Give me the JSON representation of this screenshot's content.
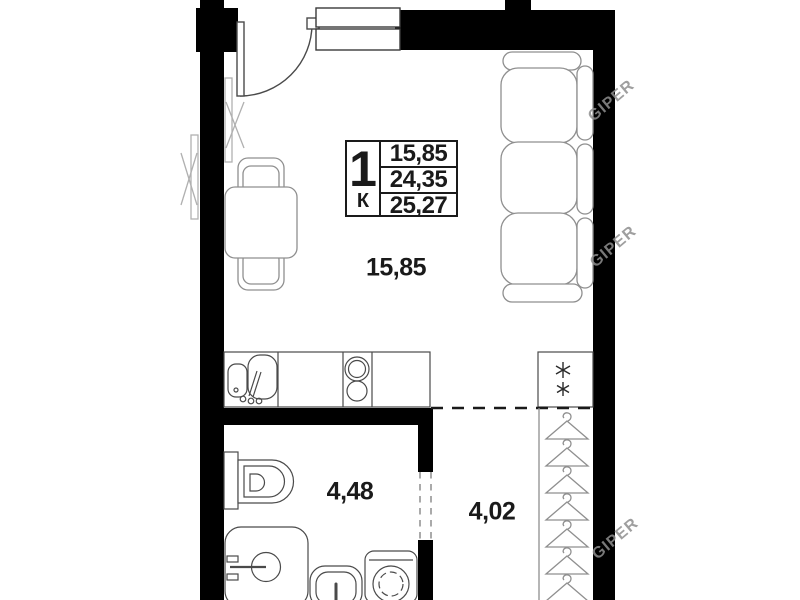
{
  "plan": {
    "info_table": {
      "rooms_count": "1",
      "room_type_letter": "К",
      "row_values": [
        "15,85",
        "24,35",
        "25,27"
      ]
    },
    "room_labels": {
      "main_room": "15,85",
      "bathroom": "4,48",
      "hallway": "4,02"
    },
    "icons": {
      "fridge": "snowflake",
      "wardrobe": "hanger"
    },
    "watermark": {
      "text": "GIPER"
    },
    "colors": {
      "wall": "#000000",
      "furniture_outline": "#8f8f8f",
      "fixture_outline": "#4a4a4a",
      "text": "#1a1a1a",
      "watermark": "#8f8f8f"
    }
  }
}
